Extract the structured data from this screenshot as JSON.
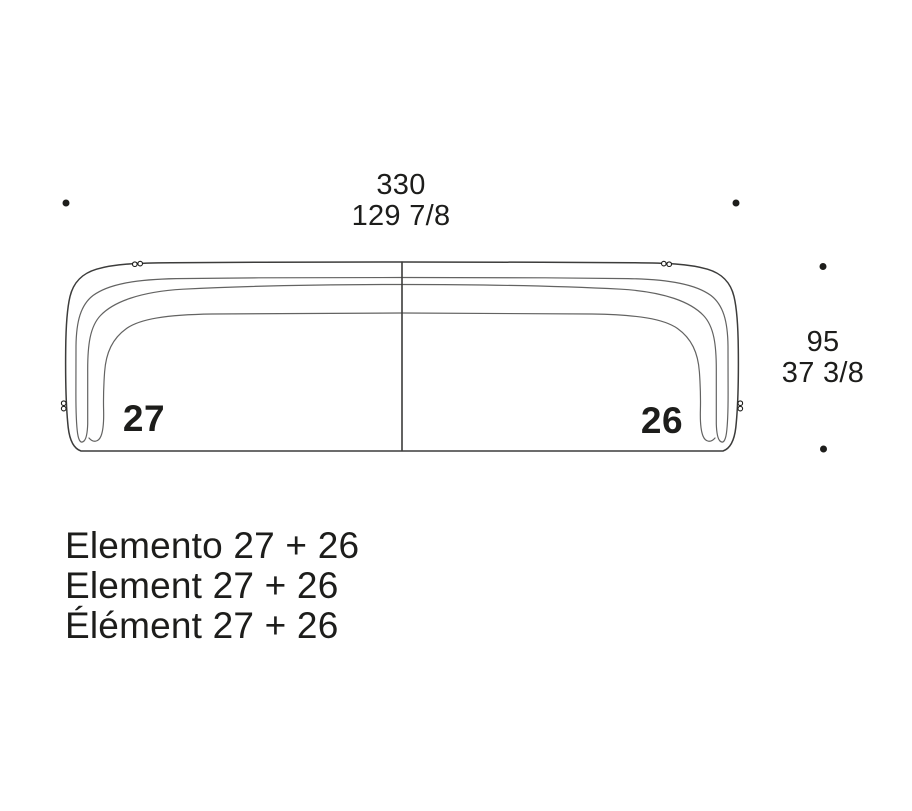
{
  "diagram": {
    "type": "sofa-top-view-spec",
    "top_dimension": {
      "cm": "330",
      "inches": "129 7/8"
    },
    "side_dimension": {
      "cm": "95",
      "inches": "37 3/8"
    },
    "left_element": {
      "number": "27"
    },
    "right_element": {
      "number": "26"
    },
    "captions": {
      "italian": "Elemento 27 + 26",
      "english": "Element 27 + 26",
      "french": "Élément 27 + 26"
    },
    "colors": {
      "ink": "#1d1d1b",
      "line_dark": "#3c3c3b",
      "line_light": "#636362",
      "background": "#ffffff"
    }
  }
}
